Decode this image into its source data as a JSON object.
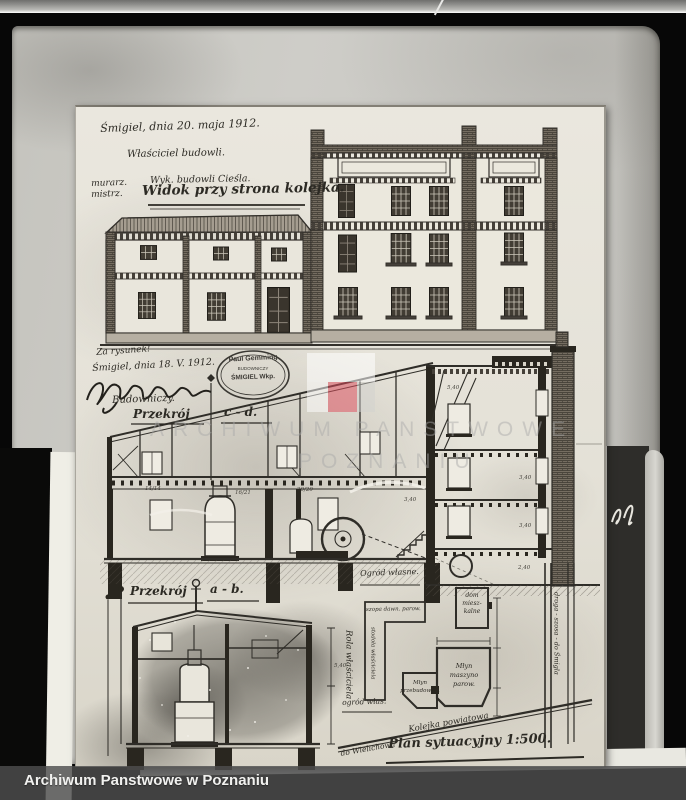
{
  "archive": {
    "watermark_line1": "ARCHIWUM PANSTWOWE",
    "watermark_line2": "POZNANIU",
    "footer_label": "Archiwum Panstwowe w Poznaniu"
  },
  "drawing": {
    "header": {
      "date_line": "Śmigiel, dnia 20. maja 1912.",
      "owner_line": "Właściciel budowli.",
      "margin_line1": "murarz.",
      "margin_line2": "mistrz.",
      "builder_line": "Wyk. budowli Cieśla.",
      "view_title": "Widok przy strona kolejka."
    },
    "middle": {
      "note": "Za rysunek!",
      "date_line": "Śmigiel, dnia 18. V. 1912.",
      "role_line": "Budowniczy.",
      "section_label": "Przekrój",
      "section_id": "c - d.",
      "stamp_name": "Paul Gemming",
      "stamp_role": "BUDOWNICZY",
      "stamp_place": "ŚMIGIEL Wkp."
    },
    "lower": {
      "section_label": "Przekrój",
      "section_id": "a - b.",
      "margin_note": "Rola właściciela"
    },
    "site_plan": {
      "garden_top": "Ogród własne.",
      "house_l1": "dom",
      "house_l2": "miesz-",
      "house_l3": "kalne",
      "shed_label": "szopa dawn. parow.",
      "barn_label": "stodoła właściciela",
      "mill_l1": "Młyn",
      "mill_l2": "maszyno",
      "mill_l3": "parow.",
      "mill2_l1": "Młyn",
      "mill2_l2": "przebudowan.",
      "garden_bottom": "ogród włas.",
      "railway_label": "Kolejka powiatowa",
      "railway_dir": "do Wielichowa",
      "road_label": "droga - szosa - do Śmigla",
      "caption": "Plan sytuacyjny 1:500."
    },
    "dims": [
      "14/14",
      "16/21",
      "20/20",
      "3,40",
      "3,40",
      "3,40",
      "5,40",
      "2,40",
      "5,40"
    ]
  },
  "colors": {
    "paper": "#e7e4db",
    "backing": "#c6c5c0",
    "ink": "#2f2d28",
    "watermark_red": "#de4e5e",
    "footer_text": "#f1f1ef"
  }
}
